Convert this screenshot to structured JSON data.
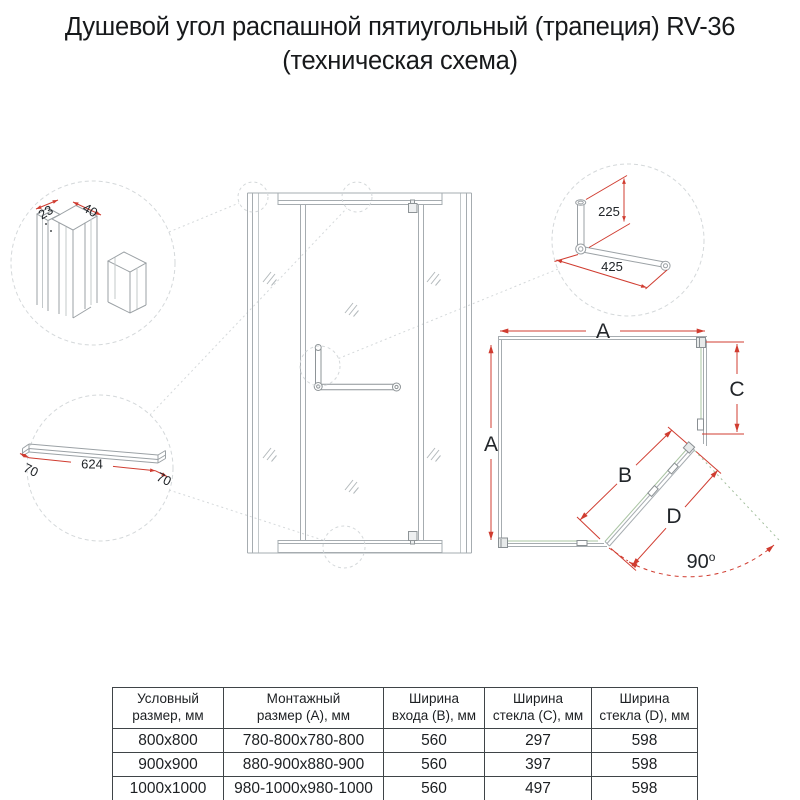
{
  "title": {
    "line1": "Душевой угол распашной пятиугольный (трапеция) RV-36",
    "line2": "(техническая схема)"
  },
  "details": {
    "profiles": {
      "dim_small": "23",
      "dim_large": "40"
    },
    "handle": {
      "dim_vertical": "225",
      "dim_horizontal": "425"
    },
    "threshold": {
      "dim_left": "70",
      "dim_center": "624",
      "dim_right": "70"
    }
  },
  "plan": {
    "label_a_top": "A",
    "label_a_left": "A",
    "label_b": "B",
    "label_c": "C",
    "label_d": "D",
    "angle_value": "90",
    "angle_unit": "o"
  },
  "table": {
    "headers": [
      "Условный\nразмер, мм",
      "Монтажный\nразмер (А), мм",
      "Ширина\nвхода (В), мм",
      "Ширина\nстекла (С), мм",
      "Ширина\nстекла (D), мм"
    ],
    "rows": [
      [
        "800x800",
        "780-800x780-800",
        "560",
        "297",
        "598"
      ],
      [
        "900x900",
        "880-900x880-900",
        "560",
        "397",
        "598"
      ],
      [
        "1000x1000",
        "980-1000x980-1000",
        "560",
        "497",
        "598"
      ]
    ]
  },
  "colors": {
    "dimension_red": "#d03c30",
    "glass_green": "#a9c4a2",
    "structure_gray": "#a6acb0",
    "text_black": "#212529"
  }
}
